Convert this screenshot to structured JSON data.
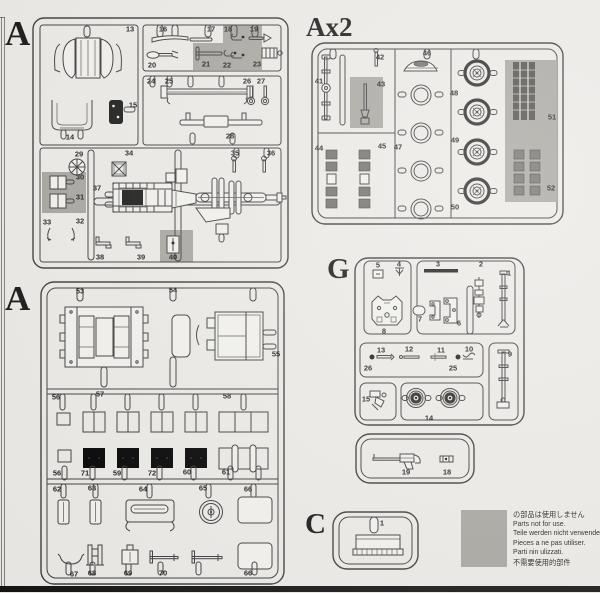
{
  "colors": {
    "background": "#ebe9e5",
    "line": "#3b3b3b",
    "not_for_use_gray": "#a6a49e",
    "footer_bar": "#141413"
  },
  "panels": {
    "a1": {
      "letter": "A",
      "parts": [
        {
          "n": "13",
          "x": 130,
          "y": 29
        },
        {
          "n": "16",
          "x": 163,
          "y": 29
        },
        {
          "n": "17",
          "x": 211,
          "y": 29
        },
        {
          "n": "18",
          "x": 228,
          "y": 29
        },
        {
          "n": "19",
          "x": 254,
          "y": 29
        },
        {
          "n": "20",
          "x": 152,
          "y": 65
        },
        {
          "n": "21",
          "x": 206,
          "y": 64
        },
        {
          "n": "22",
          "x": 227,
          "y": 65
        },
        {
          "n": "23",
          "x": 257,
          "y": 64
        },
        {
          "n": "24",
          "x": 151,
          "y": 81
        },
        {
          "n": "25",
          "x": 169,
          "y": 81
        },
        {
          "n": "26",
          "x": 247,
          "y": 81
        },
        {
          "n": "27",
          "x": 261,
          "y": 81
        },
        {
          "n": "15",
          "x": 133,
          "y": 105
        },
        {
          "n": "14",
          "x": 70,
          "y": 137
        },
        {
          "n": "28",
          "x": 230,
          "y": 136
        },
        {
          "n": "29",
          "x": 79,
          "y": 154
        },
        {
          "n": "34",
          "x": 129,
          "y": 153
        },
        {
          "n": "35",
          "x": 235,
          "y": 153
        },
        {
          "n": "36",
          "x": 271,
          "y": 153
        },
        {
          "n": "30",
          "x": 80,
          "y": 177
        },
        {
          "n": "37",
          "x": 97,
          "y": 188
        },
        {
          "n": "31",
          "x": 80,
          "y": 197
        },
        {
          "n": "33",
          "x": 47,
          "y": 222
        },
        {
          "n": "32",
          "x": 80,
          "y": 221
        },
        {
          "n": "38",
          "x": 100,
          "y": 257
        },
        {
          "n": "39",
          "x": 141,
          "y": 257
        },
        {
          "n": "40",
          "x": 173,
          "y": 257
        }
      ]
    },
    "ax2": {
      "letter": "Ax2",
      "parts": [
        {
          "n": "42",
          "x": 380,
          "y": 57
        },
        {
          "n": "46",
          "x": 427,
          "y": 53
        },
        {
          "n": "41",
          "x": 319,
          "y": 81
        },
        {
          "n": "43",
          "x": 381,
          "y": 84
        },
        {
          "n": "48",
          "x": 454,
          "y": 93
        },
        {
          "n": "51",
          "x": 552,
          "y": 117
        },
        {
          "n": "44",
          "x": 319,
          "y": 148
        },
        {
          "n": "45",
          "x": 382,
          "y": 146
        },
        {
          "n": "47",
          "x": 398,
          "y": 147
        },
        {
          "n": "49",
          "x": 455,
          "y": 140
        },
        {
          "n": "52",
          "x": 551,
          "y": 188
        },
        {
          "n": "50",
          "x": 455,
          "y": 207
        }
      ]
    },
    "a2": {
      "letter": "A",
      "parts": [
        {
          "n": "53",
          "x": 80,
          "y": 291
        },
        {
          "n": "54",
          "x": 173,
          "y": 290
        },
        {
          "n": "55",
          "x": 276,
          "y": 354
        },
        {
          "n": "56",
          "x": 56,
          "y": 397
        },
        {
          "n": "57",
          "x": 100,
          "y": 394
        },
        {
          "n": "58",
          "x": 227,
          "y": 396
        },
        {
          "n": "56",
          "x": 57,
          "y": 473
        },
        {
          "n": "71",
          "x": 85,
          "y": 473
        },
        {
          "n": "59",
          "x": 117,
          "y": 473
        },
        {
          "n": "72",
          "x": 152,
          "y": 473
        },
        {
          "n": "60",
          "x": 187,
          "y": 472
        },
        {
          "n": "61",
          "x": 226,
          "y": 472
        },
        {
          "n": "62",
          "x": 57,
          "y": 489
        },
        {
          "n": "63",
          "x": 92,
          "y": 488
        },
        {
          "n": "64",
          "x": 143,
          "y": 489
        },
        {
          "n": "65",
          "x": 203,
          "y": 488
        },
        {
          "n": "66",
          "x": 248,
          "y": 489
        },
        {
          "n": "67",
          "x": 74,
          "y": 574
        },
        {
          "n": "68",
          "x": 92,
          "y": 573
        },
        {
          "n": "69",
          "x": 128,
          "y": 573
        },
        {
          "n": "70",
          "x": 163,
          "y": 573
        },
        {
          "n": "66",
          "x": 248,
          "y": 573
        }
      ]
    },
    "g": {
      "letter": "G",
      "parts": [
        {
          "n": "5",
          "x": 378,
          "y": 265
        },
        {
          "n": "4",
          "x": 399,
          "y": 264
        },
        {
          "n": "3",
          "x": 438,
          "y": 264
        },
        {
          "n": "2",
          "x": 481,
          "y": 264
        },
        {
          "n": "1",
          "x": 509,
          "y": 273
        },
        {
          "n": "7",
          "x": 420,
          "y": 319
        },
        {
          "n": "6",
          "x": 459,
          "y": 323
        },
        {
          "n": "8",
          "x": 384,
          "y": 331
        },
        {
          "n": "13",
          "x": 381,
          "y": 350
        },
        {
          "n": "12",
          "x": 409,
          "y": 349
        },
        {
          "n": "11",
          "x": 441,
          "y": 350
        },
        {
          "n": "10",
          "x": 469,
          "y": 349
        },
        {
          "n": "26",
          "x": 368,
          "y": 368
        },
        {
          "n": "25",
          "x": 453,
          "y": 368
        },
        {
          "n": "9",
          "x": 510,
          "y": 354
        },
        {
          "n": "15",
          "x": 366,
          "y": 399
        },
        {
          "n": "14",
          "x": 429,
          "y": 418
        },
        {
          "n": "19",
          "x": 406,
          "y": 472
        },
        {
          "n": "18",
          "x": 447,
          "y": 472
        }
      ]
    },
    "c": {
      "letter": "C",
      "parts": [
        {
          "n": "1",
          "x": 382,
          "y": 523
        }
      ]
    }
  },
  "legend": {
    "lines": [
      "の部品は使用しません",
      "Parts not for use.",
      "Teile werden nicht verwendet.",
      "Pieces a ne pas utiliser.",
      "Parti nin ulizzati.",
      "不需要使用的部件"
    ]
  }
}
